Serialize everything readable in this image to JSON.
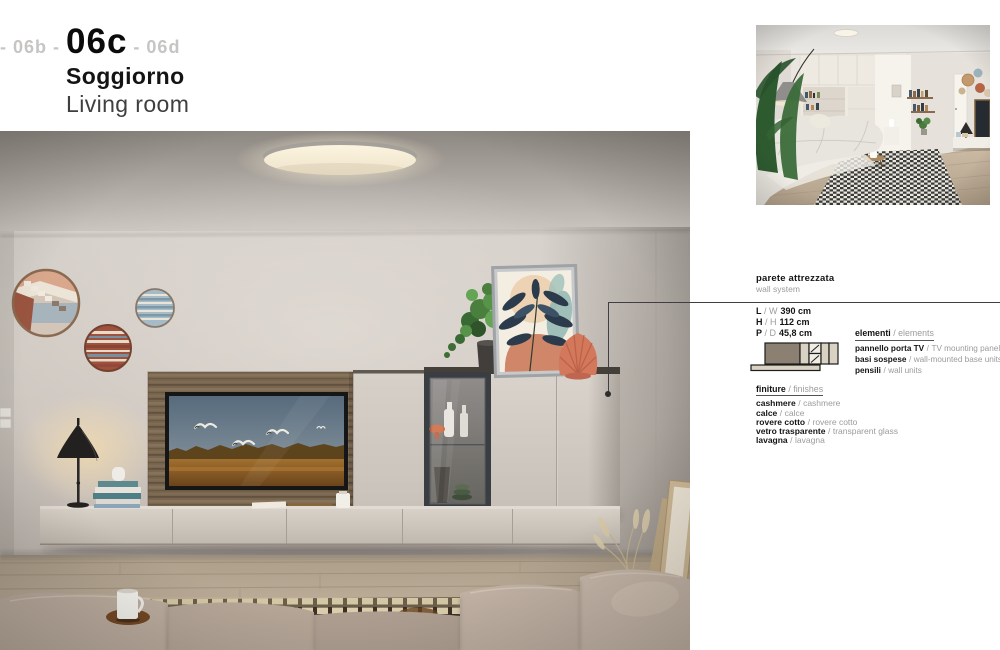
{
  "header": {
    "nav_prev": "- 06b -",
    "nav_current": "06c",
    "nav_next": "- 06d",
    "title_it": "Soggiorno",
    "title_en": "Living room"
  },
  "product": {
    "sep": "/",
    "name_it": "parete attrezzata",
    "name_en": "wall system",
    "dimensions": [
      {
        "it": "L",
        "en": "W",
        "value": "390 cm"
      },
      {
        "it": "H",
        "en": "H",
        "value": "112 cm"
      },
      {
        "it": "P",
        "en": "D",
        "value": "45,8 cm"
      }
    ],
    "elements": {
      "heading_it": "elementi",
      "heading_en": "elements",
      "items": [
        {
          "it": "pannello porta TV",
          "en": "TV mounting panel"
        },
        {
          "it": "basi sospese",
          "en": "wall-mounted base units"
        },
        {
          "it": "pensili",
          "en": "wall units"
        }
      ]
    },
    "finishes": {
      "heading_it": "finiture",
      "heading_en": "finishes",
      "items": [
        {
          "it": "cashmere",
          "en": "cashmere"
        },
        {
          "it": "calce",
          "en": "calce"
        },
        {
          "it": "rovere cotto",
          "en": "rovere cotto"
        },
        {
          "it": "vetro trasparente",
          "en": "transparent glass"
        },
        {
          "it": "lavagna",
          "en": "lavagna"
        }
      ]
    }
  },
  "colors": {
    "page_bg": "#ffffff",
    "text_dark": "#141414",
    "text_gray": "#9b9b9b",
    "nav_dim": "#c7c5c3",
    "callout_line": "#3f3f3f",
    "cashmere_finish": "#cdc5bc",
    "wood_rovere_cotto": "#77654f",
    "charcoal_frame": "#3a3e42",
    "accent_coral": "#d4785c"
  }
}
